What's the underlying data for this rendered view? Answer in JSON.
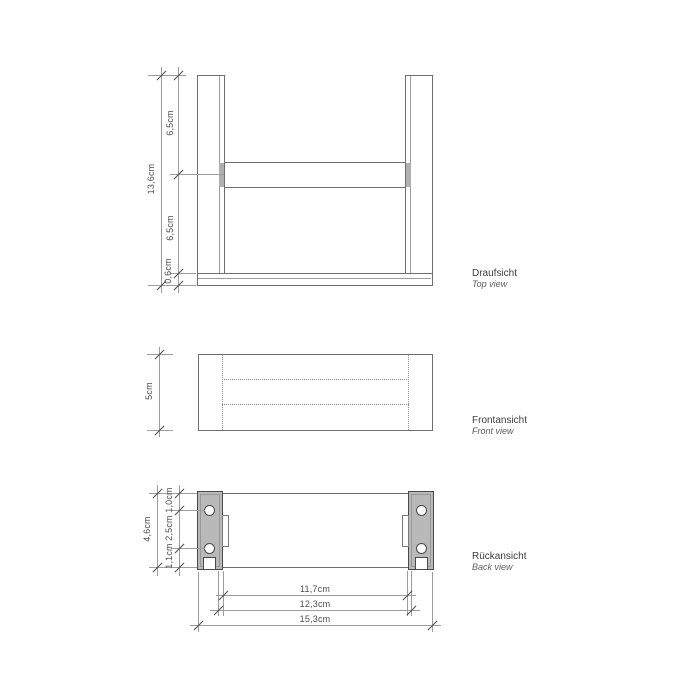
{
  "views": {
    "top": {
      "label_de": "Draufsicht",
      "label_en": "Top view",
      "dims": {
        "total": "13,6cm",
        "upper": "6,5cm",
        "lower": "6,5cm",
        "base": "0,6cm"
      }
    },
    "front": {
      "label_de": "Frontansicht",
      "label_en": "Front view",
      "dims": {
        "height": "5cm"
      }
    },
    "back": {
      "label_de": "Rückansicht",
      "label_en": "Back view",
      "dims": {
        "height": "4,6cm",
        "hole_top": "1,0cm",
        "hole_spacing": "2,5cm",
        "hole_bottom": "1,1cm",
        "inner_width": "11,7cm",
        "mount_width": "12,3cm",
        "total_width": "15,3cm"
      }
    }
  },
  "colors": {
    "background": "#ffffff",
    "dimension_line": "#9c9c9c",
    "object_line": "#6f6f6f",
    "tick": "#4e4e4e",
    "plate_fill": "#b9b9b9",
    "dimension_text": "#4e4e4e",
    "label_text": "#3d3d3d"
  }
}
